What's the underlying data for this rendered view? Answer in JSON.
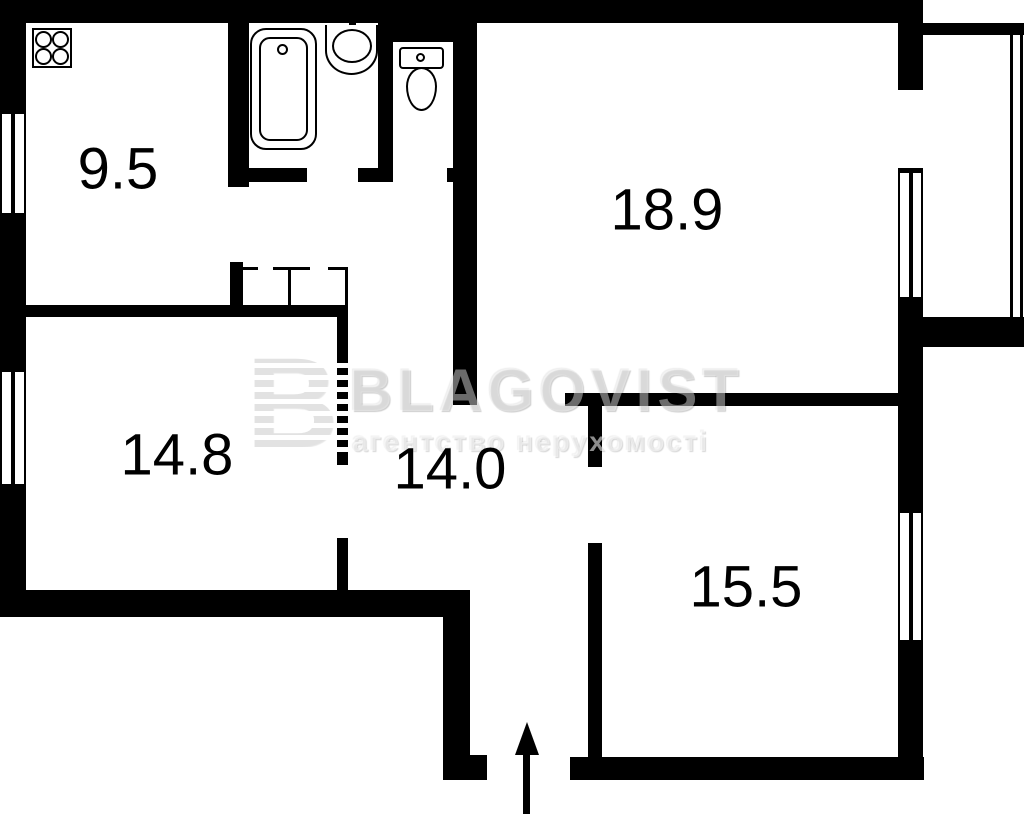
{
  "plan": {
    "rooms": [
      {
        "id": "kitchen",
        "area": "9.5"
      },
      {
        "id": "living-room",
        "area": "18.9"
      },
      {
        "id": "bedroom-left",
        "area": "14.8"
      },
      {
        "id": "hallway",
        "area": "14.0"
      },
      {
        "id": "bedroom-right",
        "area": "15.5"
      }
    ]
  },
  "watermark": {
    "logo_letter": "B",
    "brand": "BLAGOVIST",
    "tagline": "агентство нерухомості"
  },
  "icons": [
    "stove-icon",
    "bathtub-icon",
    "sink-icon",
    "toilet-icon",
    "entrance-arrow-icon",
    "window",
    "closet"
  ],
  "colors": {
    "wall": "#000000",
    "background": "#ffffff",
    "label_text": "#000000",
    "watermark_gray": "#e2e2e2"
  }
}
